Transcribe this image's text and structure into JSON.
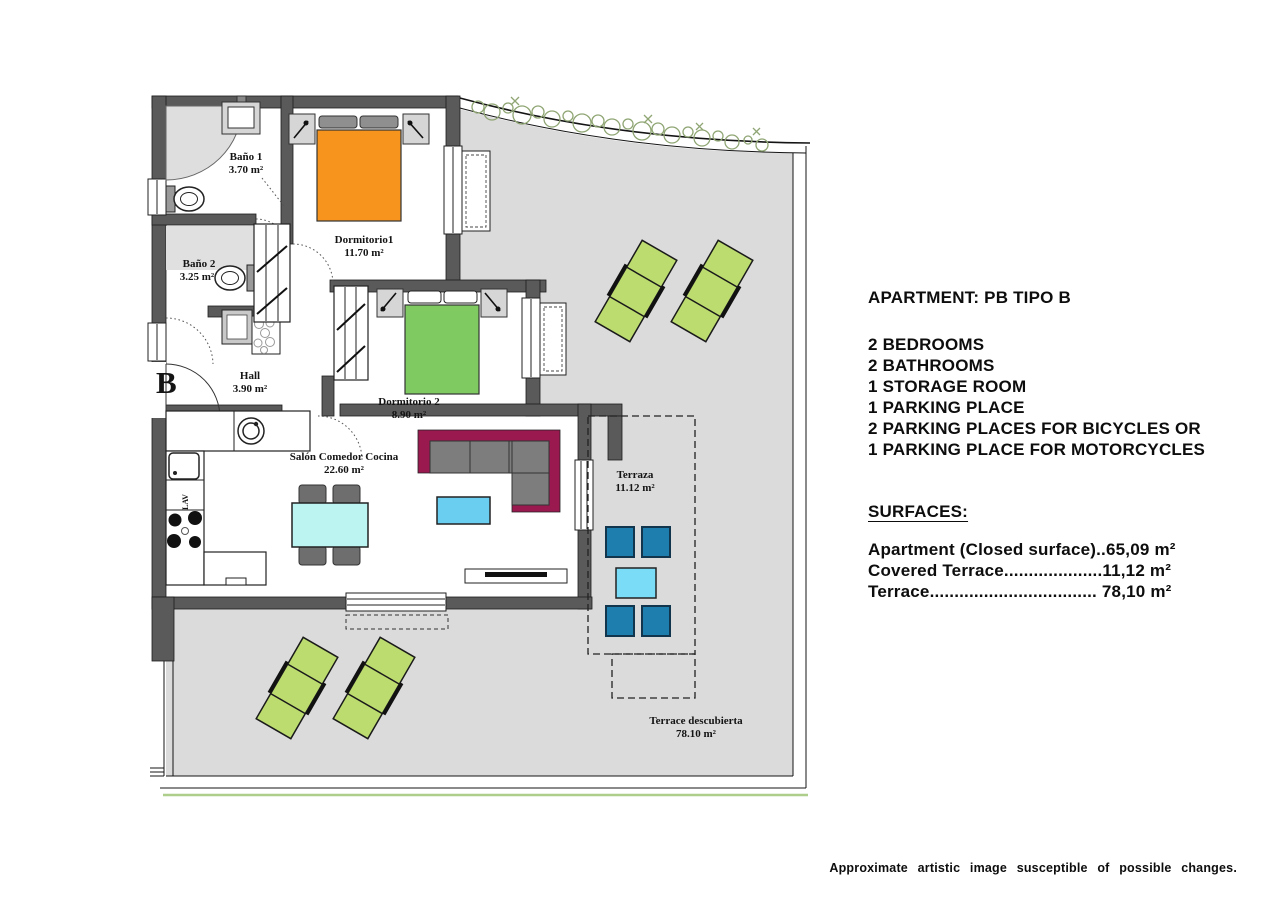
{
  "floor_plan": {
    "unit_letter": "B",
    "kitchen_label": "LAV",
    "rooms": [
      {
        "id": "bano1",
        "name": "Baño 1",
        "area": "3.70 m²"
      },
      {
        "id": "dormitorio1",
        "name": "Dormitorio1",
        "area": "11.70 m²"
      },
      {
        "id": "bano2",
        "name": "Baño 2",
        "area": "3.25 m²"
      },
      {
        "id": "hall",
        "name": "Hall",
        "area": "3.90 m²"
      },
      {
        "id": "dormitorio2",
        "name": "Dormitorio 2",
        "area": "8.90 m²"
      },
      {
        "id": "salon",
        "name": "Salón Comedor Cocina",
        "area": "22.60 m²"
      },
      {
        "id": "terraza",
        "name": "Terraza",
        "area": "11.12 m²"
      },
      {
        "id": "terrace_descubierta",
        "name": "Terrace descubierta",
        "area": "78.10 m²"
      }
    ],
    "colors": {
      "wall_gray": "#5A5A5A",
      "terrace_floor": "#DBDBDB",
      "bed_orange": "#F7941E",
      "bed_green": "#7FCB62",
      "lounger_green": "#BCDC6F",
      "terrace_chair_blue": "#1E7EAD",
      "dining_table_cyan": "#BCF4F2",
      "coffee_table_blue": "#69CEF0",
      "sofa_magenta": "#9A1A50",
      "plant_olive": "#8FA573"
    }
  },
  "info_panel": {
    "title": "APARTMENT: PB TIPO B",
    "features": [
      "2 BEDROOMS",
      "2 BATHROOMS",
      "1 STORAGE ROOM",
      "1 PARKING PLACE",
      "2 PARKING PLACES FOR BICYCLES OR",
      "1 PARKING PLACE FOR MOTORCYCLES"
    ],
    "surfaces_heading": "SURFACES:",
    "surfaces": [
      "Apartment (Closed surface)..65,09 m²",
      "Covered Terrace....................11,12 m²",
      "Terrace.................................. 78,10 m²"
    ]
  },
  "footer_note": "Approximate artistic image susceptible of possible changes."
}
